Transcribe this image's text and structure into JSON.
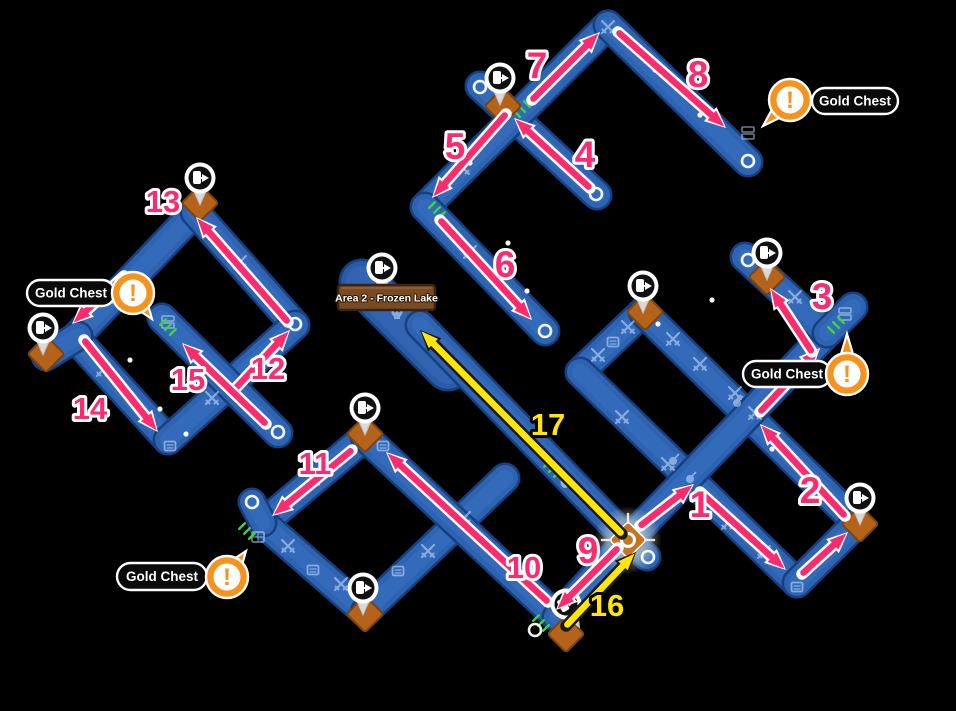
{
  "map_name": "Area 2 - Frozen Lake",
  "sign": {
    "text": "Area 2 - Frozen Lake",
    "x": 338,
    "y": 285,
    "w": 97,
    "h": 25
  },
  "colors": {
    "bg": "#000000",
    "path": "#2e63b2",
    "path_edge": "#16407f",
    "path_hi": "#3f77c9",
    "wide_path": "#2b5aa6",
    "pink": "#fb2b70",
    "yellow": "#ffe50a",
    "orange": "#f6921e",
    "diamond": "#b5631a",
    "diamond_edge": "#7d4410",
    "dash": "#3ed63e",
    "sign_fill": "#7a4a22",
    "sign_edge": "#3b2310",
    "icon": "#cfe2ff",
    "pin_disc": "#111111",
    "pill_fill": "#0a0a0a"
  },
  "paths": [
    {
      "x1": 480,
      "y1": 86,
      "x2": 597,
      "y2": 195,
      "w": 26
    },
    {
      "x1": 425,
      "y1": 207,
      "x2": 608,
      "y2": 25,
      "w": 26
    },
    {
      "x1": 608,
      "y1": 25,
      "x2": 748,
      "y2": 162,
      "w": 26
    },
    {
      "x1": 425,
      "y1": 207,
      "x2": 545,
      "y2": 331,
      "w": 26
    },
    {
      "x1": 195,
      "y1": 212,
      "x2": 75,
      "y2": 338,
      "w": 26
    },
    {
      "x1": 195,
      "y1": 212,
      "x2": 295,
      "y2": 325,
      "w": 26
    },
    {
      "x1": 75,
      "y1": 338,
      "x2": 168,
      "y2": 440,
      "w": 26
    },
    {
      "x1": 168,
      "y1": 440,
      "x2": 295,
      "y2": 325,
      "w": 26
    },
    {
      "x1": 162,
      "y1": 318,
      "x2": 278,
      "y2": 433,
      "w": 26
    },
    {
      "x1": 78,
      "y1": 336,
      "x2": 46,
      "y2": 356,
      "w": 26
    },
    {
      "x1": 365,
      "y1": 437,
      "x2": 263,
      "y2": 523,
      "w": 26
    },
    {
      "x1": 263,
      "y1": 523,
      "x2": 365,
      "y2": 612,
      "w": 26
    },
    {
      "x1": 365,
      "y1": 612,
      "x2": 505,
      "y2": 478,
      "w": 26
    },
    {
      "x1": 365,
      "y1": 437,
      "x2": 557,
      "y2": 617,
      "w": 26
    },
    {
      "x1": 557,
      "y1": 617,
      "x2": 628,
      "y2": 540,
      "w": 26
    },
    {
      "x1": 263,
      "y1": 523,
      "x2": 252,
      "y2": 502,
      "w": 24
    },
    {
      "x1": 628,
      "y1": 540,
      "x2": 647,
      "y2": 557,
      "w": 24
    },
    {
      "x1": 362,
      "y1": 282,
      "x2": 448,
      "y2": 368,
      "w": 42
    },
    {
      "x1": 420,
      "y1": 325,
      "x2": 628,
      "y2": 540,
      "w": 26
    },
    {
      "x1": 643,
      "y1": 312,
      "x2": 580,
      "y2": 372,
      "w": 26
    },
    {
      "x1": 580,
      "y1": 372,
      "x2": 797,
      "y2": 583,
      "w": 26
    },
    {
      "x1": 643,
      "y1": 312,
      "x2": 857,
      "y2": 523,
      "w": 26
    },
    {
      "x1": 628,
      "y1": 540,
      "x2": 827,
      "y2": 333,
      "w": 26
    },
    {
      "x1": 797,
      "y1": 583,
      "x2": 857,
      "y2": 523,
      "w": 26
    },
    {
      "x1": 827,
      "y1": 333,
      "x2": 745,
      "y2": 257,
      "w": 26
    },
    {
      "x1": 827,
      "y1": 333,
      "x2": 853,
      "y2": 307,
      "w": 26
    }
  ],
  "caps": [
    {
      "x": 480,
      "y": 87
    },
    {
      "x": 596,
      "y": 194
    },
    {
      "x": 748,
      "y": 161
    },
    {
      "x": 545,
      "y": 331
    },
    {
      "x": 278,
      "y": 432
    },
    {
      "x": 252,
      "y": 502
    },
    {
      "x": 535,
      "y": 630
    },
    {
      "x": 648,
      "y": 557
    },
    {
      "x": 748,
      "y": 260
    },
    {
      "x": 295,
      "y": 324
    }
  ],
  "pins": [
    {
      "x": 200,
      "y": 178,
      "r": 0
    },
    {
      "x": 43,
      "y": 328,
      "r": 0
    },
    {
      "x": 382,
      "y": 268,
      "r": 0
    },
    {
      "x": 365,
      "y": 408,
      "r": 0
    },
    {
      "x": 363,
      "y": 588,
      "r": 0
    },
    {
      "x": 566,
      "y": 604,
      "r": -30
    },
    {
      "x": 643,
      "y": 286,
      "r": 0
    },
    {
      "x": 767,
      "y": 253,
      "r": 0
    },
    {
      "x": 860,
      "y": 498,
      "r": 0
    },
    {
      "x": 500,
      "y": 78,
      "r": 0
    }
  ],
  "diamonds": [
    {
      "x": 200,
      "y": 203
    },
    {
      "x": 46,
      "y": 354
    },
    {
      "x": 365,
      "y": 434
    },
    {
      "x": 365,
      "y": 614
    },
    {
      "x": 566,
      "y": 634
    },
    {
      "x": 645,
      "y": 312
    },
    {
      "x": 767,
      "y": 277
    },
    {
      "x": 860,
      "y": 524
    },
    {
      "x": 503,
      "y": 106
    }
  ],
  "glow_node": {
    "x": 628,
    "y": 540
  },
  "gold_chests": [
    {
      "label": "Gold Chest",
      "cx": 790,
      "cy": 100,
      "tx": 763,
      "ty": 126,
      "pill": {
        "x": 812,
        "y": 88,
        "w": 86,
        "h": 26
      }
    },
    {
      "label": "Gold Chest",
      "cx": 133,
      "cy": 293,
      "tx": 152,
      "ty": 319,
      "pill": {
        "x": 27,
        "y": 280,
        "w": 88,
        "h": 26
      }
    },
    {
      "label": "Gold Chest",
      "cx": 847,
      "cy": 374,
      "tx": 847,
      "ty": 334,
      "pill": {
        "x": 743,
        "y": 361,
        "w": 88,
        "h": 26
      }
    },
    {
      "label": "Gold Chest",
      "cx": 227,
      "cy": 577,
      "tx": 246,
      "ty": 551,
      "pill": {
        "x": 117,
        "y": 563,
        "w": 90,
        "h": 27
      }
    }
  ],
  "arrows": [
    {
      "n": "1",
      "color": "pink",
      "x1": 640,
      "y1": 526,
      "x2": 694,
      "y2": 484,
      "lx": 700,
      "ly": 505
    },
    {
      "n": "",
      "color": "pink",
      "x1": 700,
      "y1": 492,
      "x2": 786,
      "y2": 570,
      "lx": 0,
      "ly": 0
    },
    {
      "n": "",
      "color": "pink",
      "x1": 802,
      "y1": 574,
      "x2": 848,
      "y2": 532,
      "lx": 0,
      "ly": 0
    },
    {
      "n": "2",
      "color": "pink",
      "x1": 845,
      "y1": 516,
      "x2": 760,
      "y2": 424,
      "lx": 810,
      "ly": 491
    },
    {
      "n": "",
      "color": "pink",
      "x1": 760,
      "y1": 412,
      "x2": 820,
      "y2": 348,
      "lx": 0,
      "ly": 0
    },
    {
      "n": "3",
      "color": "pink",
      "x1": 812,
      "y1": 352,
      "x2": 770,
      "y2": 288,
      "lx": 822,
      "ly": 297
    },
    {
      "n": "4",
      "color": "pink",
      "x1": 590,
      "y1": 188,
      "x2": 514,
      "y2": 118,
      "lx": 585,
      "ly": 155
    },
    {
      "n": "5",
      "color": "pink",
      "x1": 506,
      "y1": 114,
      "x2": 432,
      "y2": 198,
      "lx": 455,
      "ly": 147
    },
    {
      "n": "6",
      "color": "pink",
      "x1": 440,
      "y1": 220,
      "x2": 532,
      "y2": 320,
      "lx": 505,
      "ly": 265
    },
    {
      "n": "7",
      "color": "pink",
      "x1": 532,
      "y1": 100,
      "x2": 600,
      "y2": 32,
      "lx": 537,
      "ly": 66
    },
    {
      "n": "8",
      "color": "pink",
      "x1": 618,
      "y1": 32,
      "x2": 726,
      "y2": 128,
      "lx": 698,
      "ly": 75
    },
    {
      "n": "9",
      "color": "pink",
      "x1": 618,
      "y1": 548,
      "x2": 556,
      "y2": 610,
      "lx": 588,
      "ly": 551
    },
    {
      "n": "10",
      "color": "pink",
      "x1": 548,
      "y1": 602,
      "x2": 386,
      "y2": 452,
      "lx": 524,
      "ly": 566
    },
    {
      "n": "11",
      "color": "pink",
      "x1": 352,
      "y1": 450,
      "x2": 272,
      "y2": 516,
      "lx": 315,
      "ly": 462
    },
    {
      "n": "12",
      "color": "pink",
      "x1": 234,
      "y1": 390,
      "x2": 290,
      "y2": 330,
      "lx": 268,
      "ly": 367
    },
    {
      "n": "13",
      "color": "pink",
      "x1": 288,
      "y1": 322,
      "x2": 196,
      "y2": 217,
      "lx": 163,
      "ly": 200
    },
    {
      "n": "14",
      "color": "pink",
      "x1": 84,
      "y1": 340,
      "x2": 158,
      "y2": 432,
      "lx": 90,
      "ly": 407
    },
    {
      "n": "15",
      "color": "pink",
      "x1": 266,
      "y1": 424,
      "x2": 182,
      "y2": 343,
      "lx": 188,
      "ly": 378
    },
    {
      "n": "",
      "color": "pink",
      "x1": 124,
      "y1": 276,
      "x2": 72,
      "y2": 324,
      "lx": 0,
      "ly": 0
    },
    {
      "n": "16",
      "color": "yellow",
      "x1": 566,
      "y1": 626,
      "x2": 636,
      "y2": 552,
      "lx": 607,
      "ly": 604
    },
    {
      "n": "17",
      "color": "yellow",
      "x1": 622,
      "y1": 534,
      "x2": 420,
      "y2": 330,
      "lx": 548,
      "ly": 423
    }
  ],
  "icons": [
    {
      "t": "swords",
      "x": 608,
      "y": 27
    },
    {
      "t": "swords",
      "x": 463,
      "y": 168
    },
    {
      "t": "swords",
      "x": 470,
      "y": 252
    },
    {
      "t": "swords",
      "x": 628,
      "y": 327
    },
    {
      "t": "swords",
      "x": 598,
      "y": 355
    },
    {
      "t": "swords",
      "x": 673,
      "y": 339
    },
    {
      "t": "swords",
      "x": 700,
      "y": 364
    },
    {
      "t": "swords",
      "x": 735,
      "y": 393
    },
    {
      "t": "swords",
      "x": 755,
      "y": 413
    },
    {
      "t": "swords",
      "x": 622,
      "y": 417
    },
    {
      "t": "swords",
      "x": 668,
      "y": 464
    },
    {
      "t": "swords",
      "x": 728,
      "y": 523
    },
    {
      "t": "swords",
      "x": 764,
      "y": 552
    },
    {
      "t": "swords",
      "x": 785,
      "y": 375
    },
    {
      "t": "swords",
      "x": 240,
      "y": 262
    },
    {
      "t": "swords",
      "x": 103,
      "y": 370
    },
    {
      "t": "swords",
      "x": 212,
      "y": 398
    },
    {
      "t": "swords",
      "x": 288,
      "y": 546
    },
    {
      "t": "swords",
      "x": 341,
      "y": 584
    },
    {
      "t": "swords",
      "x": 428,
      "y": 551
    },
    {
      "t": "swords",
      "x": 313,
      "y": 479
    },
    {
      "t": "swords",
      "x": 464,
      "y": 518
    },
    {
      "t": "swords",
      "x": 795,
      "y": 297
    },
    {
      "t": "swords",
      "x": 118,
      "y": 297
    },
    {
      "t": "card",
      "x": 613,
      "y": 342
    },
    {
      "t": "card",
      "x": 383,
      "y": 446
    },
    {
      "t": "card",
      "x": 313,
      "y": 570
    },
    {
      "t": "card",
      "x": 398,
      "y": 571
    },
    {
      "t": "card",
      "x": 797,
      "y": 587
    },
    {
      "t": "card",
      "x": 170,
      "y": 446
    },
    {
      "t": "stack",
      "x": 748,
      "y": 133
    },
    {
      "t": "stack",
      "x": 168,
      "y": 322
    },
    {
      "t": "stack",
      "x": 845,
      "y": 314
    },
    {
      "t": "grid",
      "x": 258,
      "y": 537
    },
    {
      "t": "bomb",
      "x": 673,
      "y": 460
    },
    {
      "t": "bomb",
      "x": 690,
      "y": 478
    },
    {
      "t": "bomb",
      "x": 737,
      "y": 402
    },
    {
      "t": "oval",
      "x": 565,
      "y": 482
    },
    {
      "t": "skull",
      "x": 397,
      "y": 313
    }
  ],
  "dots": [
    {
      "x": 565,
      "y": 65
    },
    {
      "x": 655,
      "y": 70
    },
    {
      "x": 700,
      "y": 115
    },
    {
      "x": 470,
      "y": 163
    },
    {
      "x": 508,
      "y": 243
    },
    {
      "x": 527,
      "y": 291
    },
    {
      "x": 233,
      "y": 257
    },
    {
      "x": 160,
      "y": 409
    },
    {
      "x": 186,
      "y": 434
    },
    {
      "x": 432,
      "y": 491
    },
    {
      "x": 501,
      "y": 562
    },
    {
      "x": 599,
      "y": 572
    },
    {
      "x": 658,
      "y": 324
    },
    {
      "x": 772,
      "y": 449
    },
    {
      "x": 712,
      "y": 300
    },
    {
      "x": 248,
      "y": 371
    },
    {
      "x": 130,
      "y": 360
    }
  ],
  "dashes": [
    {
      "x": 522,
      "y": 109,
      "a": -45
    },
    {
      "x": 168,
      "y": 327,
      "a": 45
    },
    {
      "x": 836,
      "y": 325,
      "a": -45
    },
    {
      "x": 552,
      "y": 469,
      "a": 45
    },
    {
      "x": 541,
      "y": 623,
      "a": 45
    },
    {
      "x": 247,
      "y": 531,
      "a": 45
    },
    {
      "x": 437,
      "y": 210,
      "a": 45
    }
  ]
}
